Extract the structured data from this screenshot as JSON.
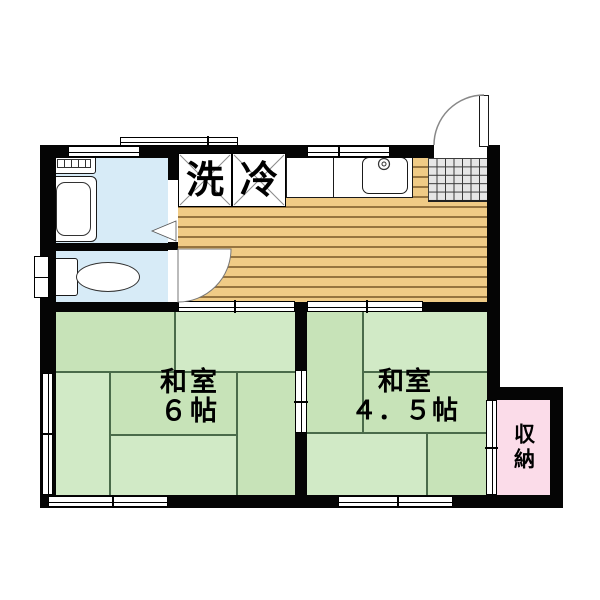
{
  "floorplan": {
    "title": "1DK apartment floor plan",
    "labels": {
      "washing_machine": "洗",
      "refrigerator": "冷",
      "storage": "収納",
      "room6": {
        "name": "和室",
        "size": "６帖"
      },
      "room45": {
        "name": "和室",
        "size": "４．５帖"
      }
    },
    "rooms": [
      {
        "name": "和室",
        "size": "６帖",
        "type": "tatami-room"
      },
      {
        "name": "和室",
        "size": "４．５帖",
        "type": "tatami-room"
      },
      {
        "name": "収納",
        "type": "storage-closet"
      },
      {
        "name": "",
        "type": "kitchen-dining-wood-floor"
      },
      {
        "name": "",
        "type": "bathroom-with-tub"
      },
      {
        "name": "",
        "type": "toilet-room"
      },
      {
        "name": "",
        "type": "entry-genkan-tiled"
      }
    ],
    "features": [
      "bathtub",
      "water-heater-panel",
      "toilet",
      "kitchen-counter-sink",
      "entrance-swing-door",
      "interior-swing-door",
      "folding-bath-door",
      "sliding-doors",
      "windows"
    ],
    "colors": {
      "wall": "#050505",
      "tatami_green": "#cbe6bd",
      "wet_area_blue": "#d7ebf7",
      "wood_floor_tan": "#f0cb86",
      "wood_floor_line": "#96743f",
      "storage_pink": "#fbdce9",
      "entry_tile_gray": "#e6e6e6",
      "text": "#000000"
    }
  }
}
